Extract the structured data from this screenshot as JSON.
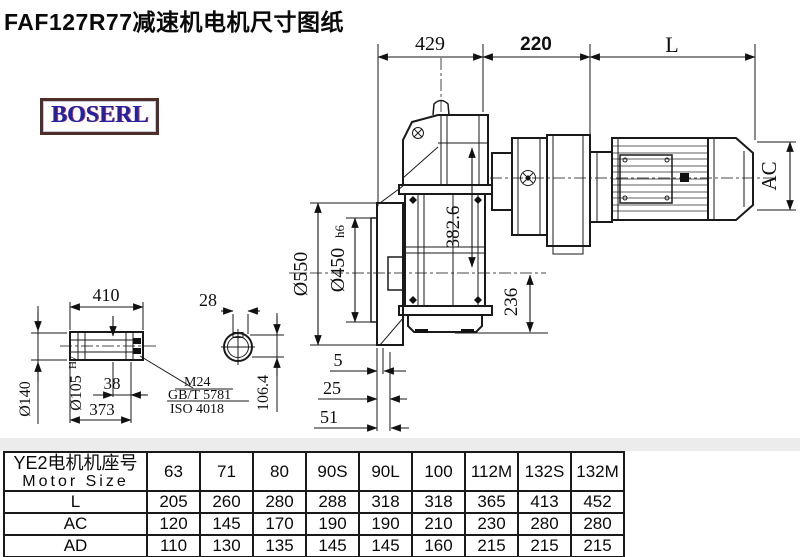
{
  "title": "FAF127R77减速机电机尺寸图纸",
  "logo": "BOSERL",
  "dims": {
    "top_429": "429",
    "top_220": "220",
    "top_L": "L",
    "ac": "AC",
    "d550": "Ø550",
    "d450": "Ø450",
    "d450_suffix": "h6",
    "v382": "382.6",
    "v236": "236",
    "len410": "410",
    "k28": "28",
    "h106": "106.4",
    "d140": "Ø140",
    "d105": "Ø105",
    "d105_sup": "H7",
    "k38": "38",
    "len373": "373",
    "g5": "5",
    "g25": "25",
    "g51": "51",
    "leader_line1": "M24",
    "leader_line2": "GB/T 5781",
    "leader_line3": "ISO 4018"
  },
  "table": {
    "header": {
      "line1": "YE2电机机座号",
      "line2": "Motor Size",
      "cols": [
        "63",
        "71",
        "80",
        "90S",
        "90L",
        "100",
        "112M",
        "132S",
        "132M"
      ]
    },
    "rows": [
      {
        "label": "L",
        "values": [
          "205",
          "260",
          "280",
          "288",
          "318",
          "318",
          "365",
          "413",
          "452"
        ]
      },
      {
        "label": "AC",
        "values": [
          "120",
          "145",
          "170",
          "190",
          "190",
          "210",
          "230",
          "280",
          "280"
        ]
      },
      {
        "label": "AD",
        "values": [
          "110",
          "130",
          "135",
          "145",
          "145",
          "160",
          "215",
          "215",
          "215"
        ]
      }
    ]
  }
}
